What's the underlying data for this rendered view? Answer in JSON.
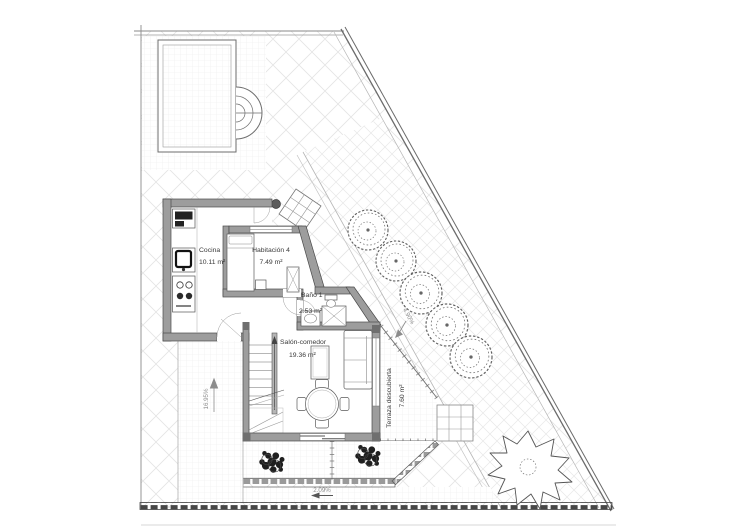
{
  "plan": {
    "rooms": {
      "cocina": {
        "label": "Cocina",
        "area": "10.11 m²"
      },
      "habitacion4": {
        "label": "Habitación 4",
        "area": "7.49 m²"
      },
      "bano1": {
        "label": "Baño 1",
        "area": "2.53 m²"
      },
      "salon": {
        "label": "Salón-comedor",
        "area": "19.36 m²"
      },
      "terraza": {
        "label": "Terraza descubierta",
        "area": "7.60 m²"
      }
    },
    "slopes": {
      "ramp": "16.95%",
      "driveway": "4.90%",
      "street": "2.09%"
    },
    "colors": {
      "wall": "#9d9d9d",
      "line": "#6e6e6e",
      "hatch": "#e4e4e4",
      "text": "#3a3a3a"
    }
  }
}
